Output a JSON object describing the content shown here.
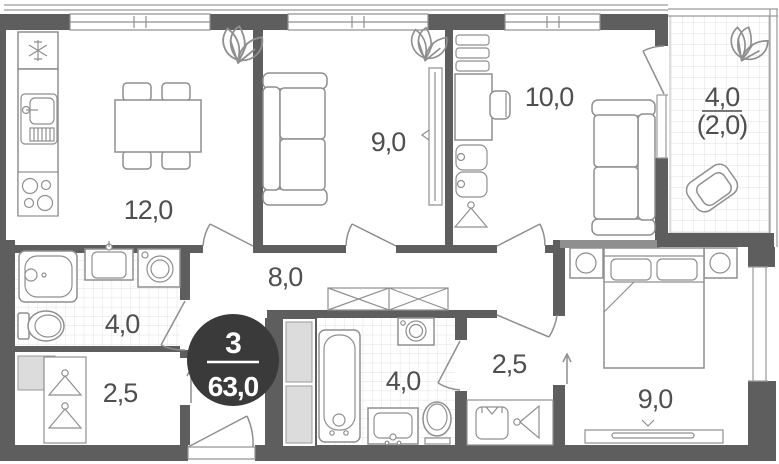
{
  "plan_title": "apartment-floor-plan",
  "badge": {
    "rooms_count": "3",
    "total_area": "63,0"
  },
  "rooms": {
    "kitchen_living": {
      "area": "12,0"
    },
    "living_room": {
      "area": "9,0"
    },
    "room_10": {
      "area": "10,0"
    },
    "balcony": {
      "area": "4,0",
      "area_counted": "(2,0)"
    },
    "hallway": {
      "area": "8,0"
    },
    "bathroom": {
      "area": "4,0"
    },
    "wardrobe": {
      "area": "2,5"
    },
    "bathroom_2": {
      "area": "4,0"
    },
    "hall": {
      "area": "2,5"
    },
    "bedroom": {
      "area": "9,0"
    }
  },
  "colors": {
    "background": "#ffffff",
    "wall": "#5e5e5e",
    "wall_light": "#8f8f8f",
    "furniture_line": "#8f8f8f",
    "thin_line": "#9a9a9a",
    "tile_line": "#e2e2e2",
    "shaft_fill": "#dcdcdc",
    "badge_bg": "#3a3a3a",
    "badge_text": "#ffffff",
    "label_text": "#4f4f4f"
  }
}
